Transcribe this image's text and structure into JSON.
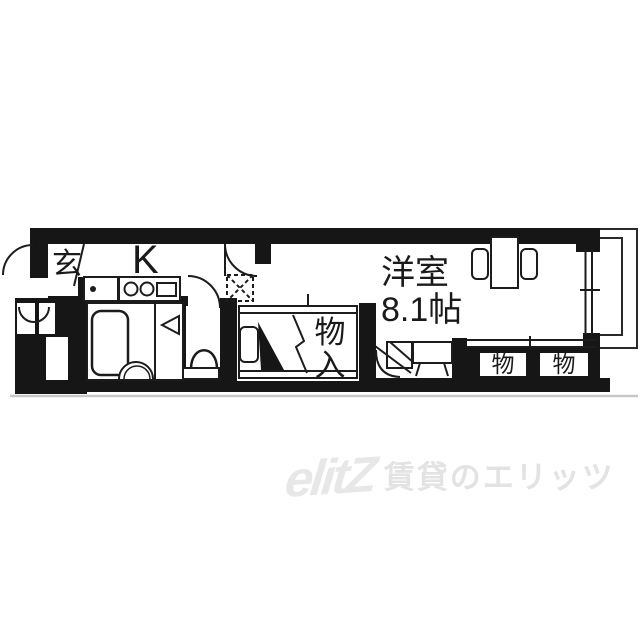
{
  "floorplan": {
    "labels": {
      "entrance": "玄",
      "kitchen": "K",
      "main_room_name": "洋室",
      "main_room_size": "8.1帖",
      "closet_char_top": "物",
      "closet_char_bottom": "入",
      "storage_left": "物",
      "storage_right": "物"
    },
    "colors": {
      "wall": "#161616",
      "line": "#1c1c1c",
      "background": "#ffffff",
      "shadow_line": "#c7c7c7"
    }
  },
  "watermark": {
    "logo_text": "elitZ",
    "brand_text": "賃貸のエリッツ",
    "color": "#e4e4e4"
  }
}
